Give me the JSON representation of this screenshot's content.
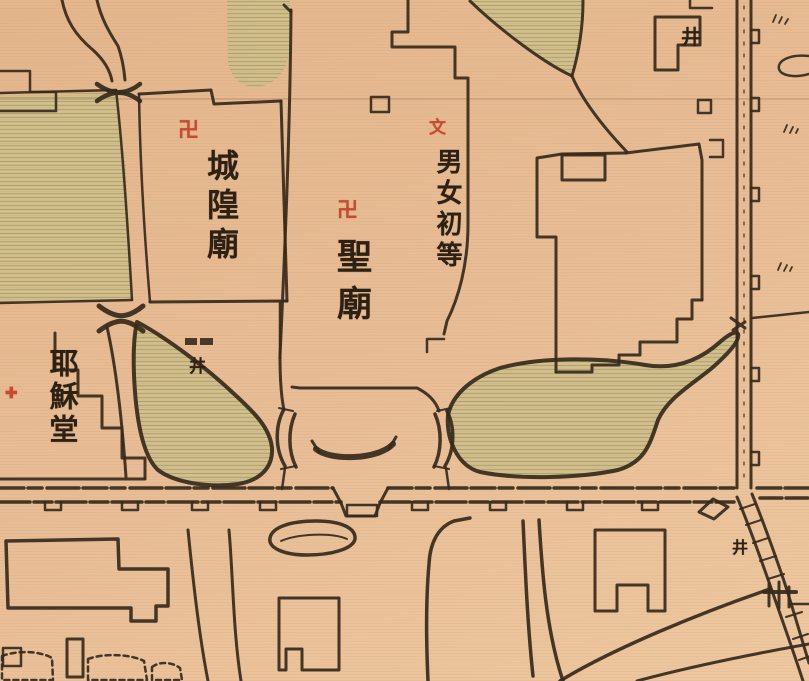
{
  "canvas": {
    "width": 809,
    "height": 681
  },
  "palette": {
    "paper": "#e8bc94",
    "paper_light": "#eec8a0",
    "paper_dark": "#e4b68c",
    "shade": "#cfc08c",
    "shade_line": "#b3a06e",
    "ink": "#362a1c",
    "red": "#c74a33",
    "glyph": "#2d2114"
  },
  "labels": {
    "city_god_temple": {
      "text": "城隍廟",
      "symbol": "卍",
      "symbol_meaning": "temple-swastika"
    },
    "sacred_temple": {
      "text": "聖廟",
      "symbol": "卍",
      "symbol_meaning": "temple-swastika"
    },
    "elementary_school": {
      "text": "男女初等",
      "symbol": "文",
      "symbol_meaning": "school-mark"
    },
    "jesus_church": {
      "text": "耶穌堂",
      "symbol": "✚",
      "symbol_meaning": "church-cross"
    },
    "well_courtyard": {
      "text": "井"
    },
    "well_top_right": {
      "text": "井"
    },
    "well_bottom_right": {
      "text": "井"
    }
  }
}
